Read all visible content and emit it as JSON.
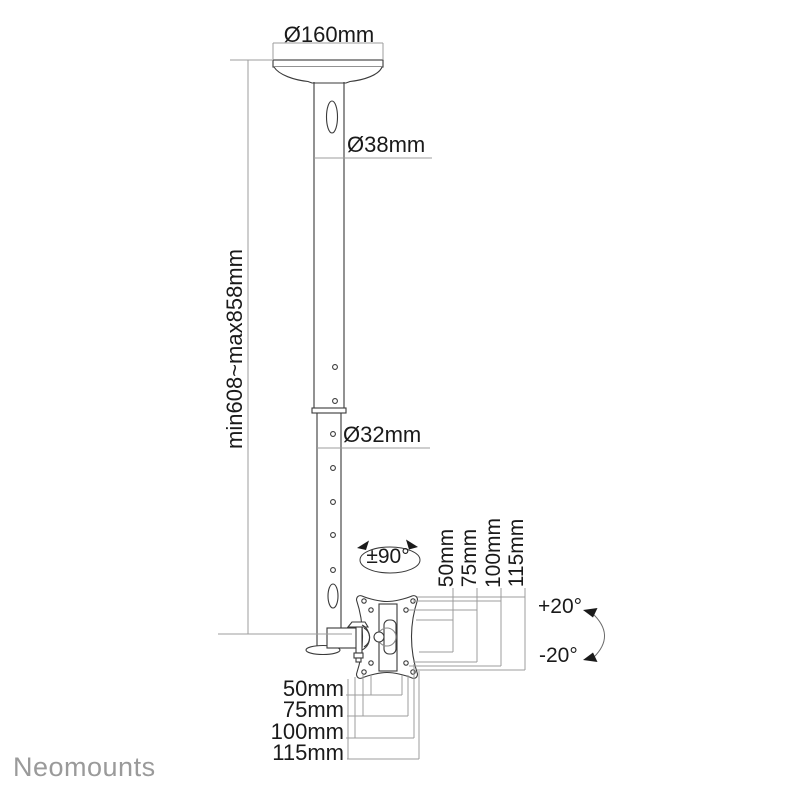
{
  "diagram": {
    "labels": {
      "top_diameter": "Ø160mm",
      "upper_tube_diameter": "Ø38mm",
      "lower_tube_diameter": "Ø32mm",
      "height_range": "min608~max858mm",
      "swivel_range": "±90°",
      "tilt_up": "+20°",
      "tilt_down": "-20°"
    },
    "vesa_vertical_labels": [
      "50mm",
      "75mm",
      "100mm",
      "115mm"
    ],
    "vesa_horizontal_labels": [
      "50mm",
      "75mm",
      "100mm",
      "115mm"
    ],
    "colors": {
      "part_line": "#3a3a3a",
      "dimension_line": "#9c9c9c",
      "text": "#1a1a1a",
      "logo": "#9a9a9a",
      "background": "#ffffff"
    }
  },
  "brand": {
    "logo_text": "Neomounts"
  }
}
